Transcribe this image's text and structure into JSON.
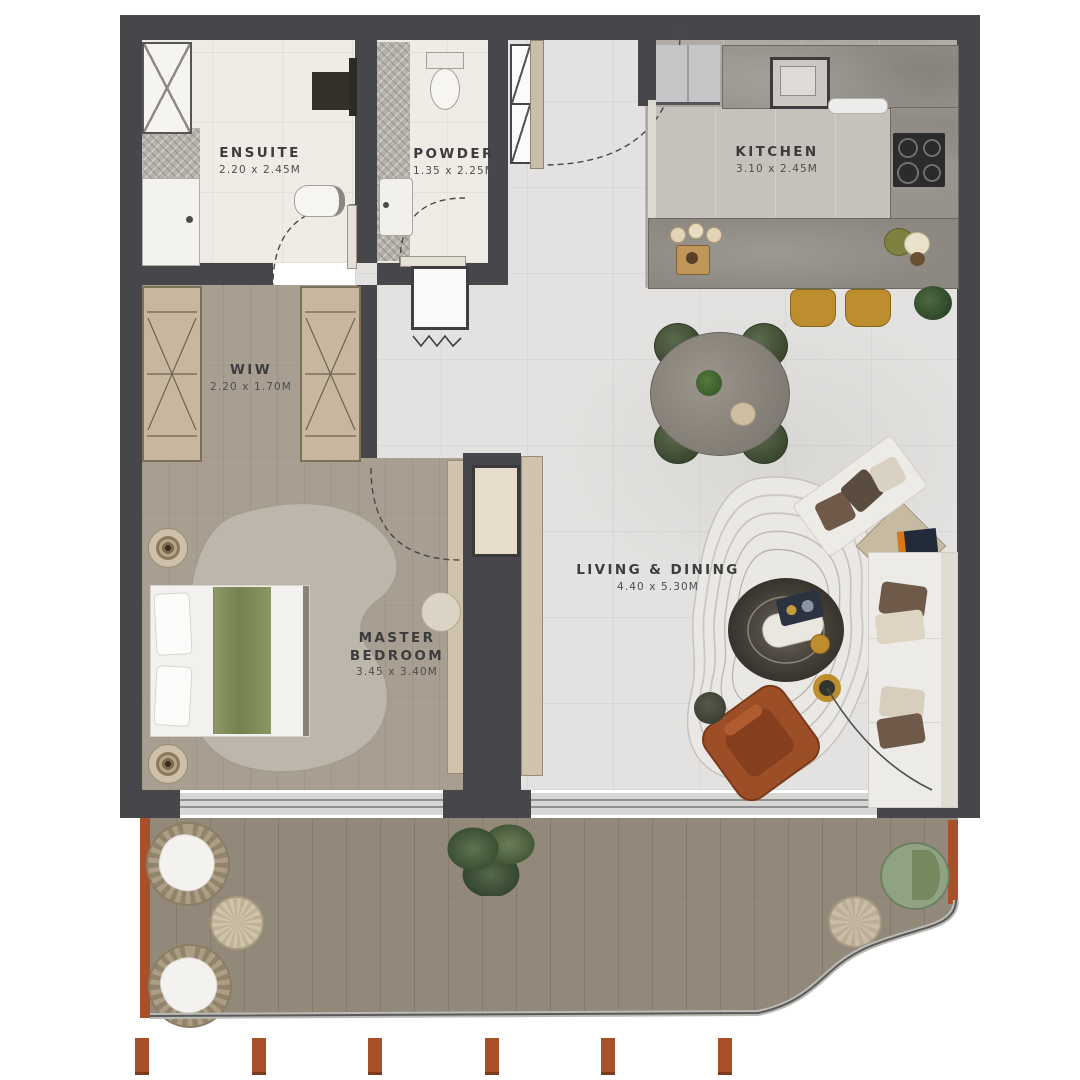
{
  "floorplan": {
    "title": "apartment-floor-plan",
    "rooms": [
      {
        "key": "ensuite",
        "label": "ENSUITE",
        "dimensions": "2.20 x 2.45M"
      },
      {
        "key": "powder",
        "label": "POWDER",
        "dimensions": "1.35 x 2.25M"
      },
      {
        "key": "kitchen",
        "label": "KITCHEN",
        "dimensions": "3.10 x 2.45M"
      },
      {
        "key": "wiw",
        "label": "WIW",
        "dimensions": "2.20 x 1.70M"
      },
      {
        "key": "master_bedroom",
        "label": "MASTER BEDROOM",
        "dimensions": "3.45 x 3.40M"
      },
      {
        "key": "living_dining",
        "label": "LIVING & DINING",
        "dimensions": "4.40 x 5.30M"
      }
    ],
    "colors": {
      "wall": "#47474b",
      "marble_floor": "#e3e2e0",
      "kitchen_floor": "#b0aca5",
      "wood_floor": "#a89e91",
      "deck_floor": "#93897b",
      "bathroom_floor": "#efece5",
      "accent_rust": "#a8502a",
      "stool_gold": "#bd8e2e",
      "dining_chair_green": "#3e4d36",
      "bed_throw_green": "#7d8a62",
      "armchair_rust": "#9c4e27"
    }
  }
}
